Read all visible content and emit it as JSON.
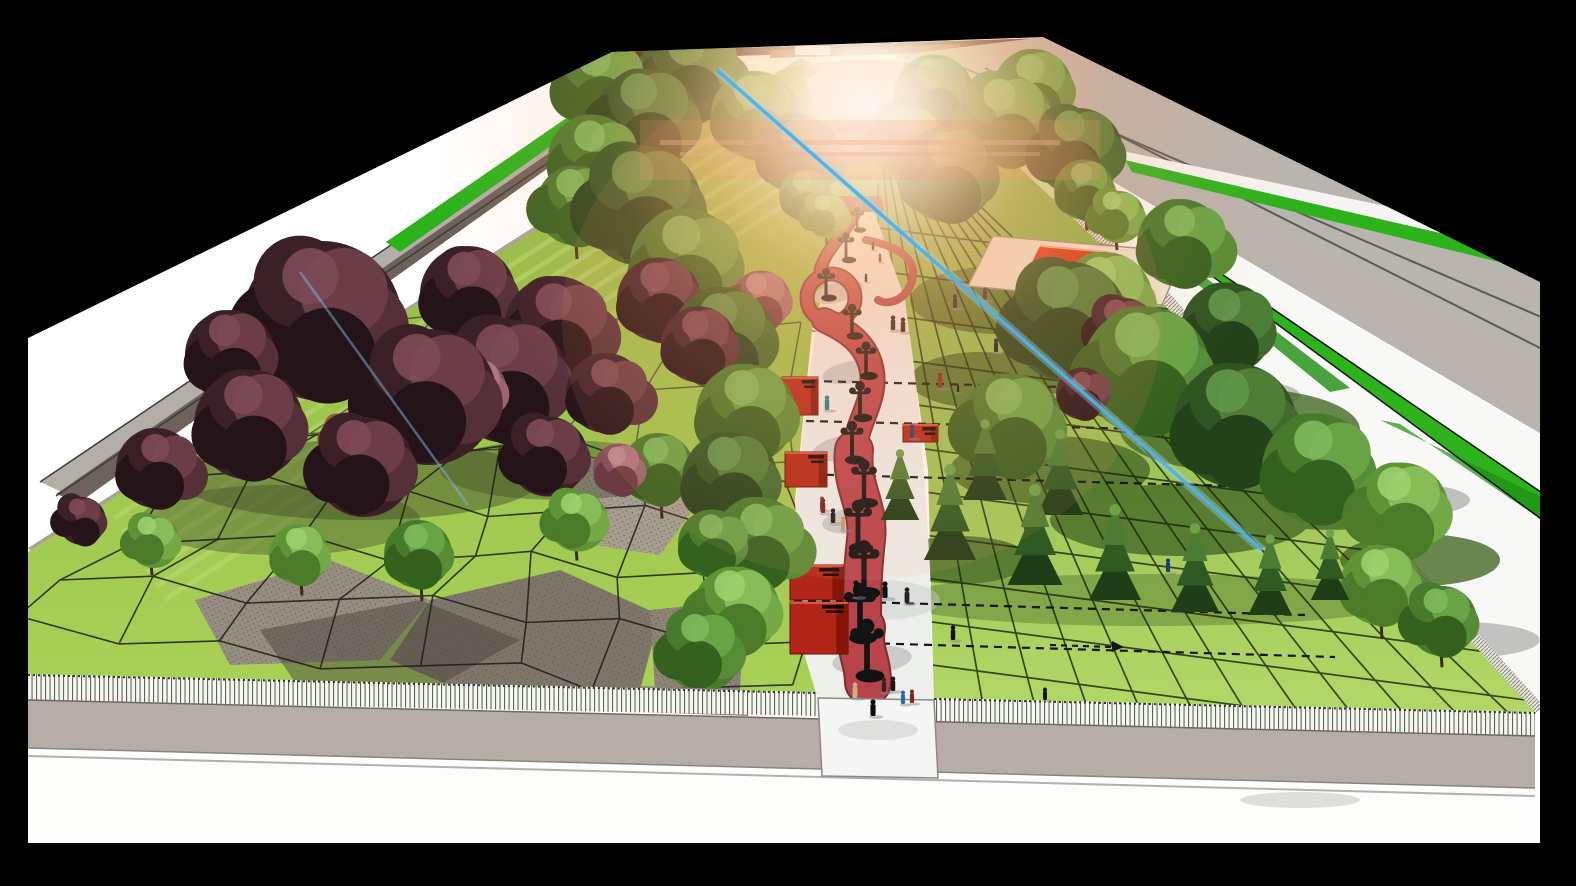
{
  "scene": {
    "title": "park-masterplan-perspective-rendering",
    "description": "Aerial one-point-perspective SketchUp-style rendering of a linear park between two roads: central promenade with red serpentine path, ornate lamppost silhouettes, red wayfinding signs, purple and green tree groves, gridded lawns with gravel patches, white picket fence, flat pavilion with red skylight, sun flare and blue lens streaks, black letterbox frame.",
    "colors": {
      "frame_black": "#000000",
      "sky_white": "#ffffff",
      "horizon_maroon": "#4f1d20",
      "field_green": "#7fbc33",
      "hedge_green": "#2cb31c",
      "hedge_green_dark": "#1d8f12",
      "road_gray": "#b9b4ae",
      "median_light": "#b3aea6",
      "median_dark": "#6d6159",
      "curb_gray": "#a9a299",
      "fence_band": "#e6e3dc",
      "lawn_left": "#9cc24d",
      "lawn_left_deep": "#8ab542",
      "lawn_right_light": "#b2d765",
      "lawn_right_dark": "#7aa83e",
      "lawn_shadow": "#476a26",
      "gravel": "#968e80",
      "gravel_dark": "#7e7769",
      "gravel_light": "#a79e8f",
      "grid_line": "#1c1c1c",
      "promenade": "#edefed",
      "pavement_shadow": "#c6c9c6",
      "ribbon_red": "#b8434b",
      "ribbon_edge": "#7e2b31",
      "deck_red": "#7c2c2d",
      "sign_red": "#b22618",
      "sign_shade": "#841608",
      "pavilion_roof": "#ece5d2",
      "pavilion_skylight": "#d63c16",
      "pavilion_skylight_front": "#8c1d0a",
      "picket_white": "#f5f7f1",
      "sidewalk": "#b6aea6",
      "street_white": "#fdfdfc",
      "flare_warm": "#ffb77e",
      "streak_blue": "#4fb3e6",
      "hill_left": "#8ba04e",
      "hill_right": "#97a45c",
      "silhouette": "#141414"
    },
    "sun_flare": {
      "cx": 862,
      "cy": 108,
      "radius": 430
    },
    "lens_streaks": [
      {
        "x1": 717,
        "y1": 70,
        "x2": 1262,
        "y2": 550
      },
      {
        "x1": 300,
        "y1": 272,
        "x2": 468,
        "y2": 505
      }
    ],
    "trees": [
      [
        600,
        85,
        46,
        "green-mid"
      ],
      [
        692,
        75,
        50,
        "green-dark"
      ],
      [
        935,
        95,
        40,
        "green-dark"
      ],
      [
        1035,
        90,
        40,
        "green-mid"
      ],
      [
        645,
        120,
        52,
        "green-dark"
      ],
      [
        755,
        115,
        44,
        "green-mid"
      ],
      [
        905,
        140,
        36,
        "green-mid"
      ],
      [
        1005,
        120,
        46,
        "green-mid"
      ],
      [
        800,
        155,
        40,
        "green-dark"
      ],
      [
        595,
        160,
        44,
        "green-mid"
      ],
      [
        1075,
        150,
        44,
        "green-dark"
      ],
      [
        950,
        175,
        48,
        "green-dark"
      ],
      [
        805,
        195,
        26,
        "green-mid"
      ],
      [
        1085,
        190,
        30,
        "green-mid"
      ],
      [
        575,
        205,
        40,
        "green-mid"
      ],
      [
        640,
        205,
        60,
        "green-dark"
      ],
      [
        825,
        215,
        22,
        "green-light"
      ],
      [
        1115,
        215,
        26,
        "green-light"
      ],
      [
        1185,
        245,
        44,
        "green-mid"
      ],
      [
        688,
        265,
        55,
        "green-mid"
      ],
      [
        660,
        300,
        42,
        "purple"
      ],
      [
        470,
        295,
        48,
        "purple"
      ],
      [
        1105,
        300,
        48,
        "green-light"
      ],
      [
        760,
        300,
        30,
        "mauve"
      ],
      [
        320,
        320,
        80,
        "purple"
      ],
      [
        1065,
        320,
        60,
        "green-dark"
      ],
      [
        1120,
        330,
        34,
        "purple"
      ],
      [
        230,
        355,
        45,
        "purple"
      ],
      [
        560,
        330,
        52,
        "purple"
      ],
      [
        725,
        340,
        52,
        "green-dark"
      ],
      [
        505,
        380,
        62,
        "purple"
      ],
      [
        1145,
        370,
        64,
        "green-mid"
      ],
      [
        1230,
        330,
        46,
        "green-dark"
      ],
      [
        425,
        395,
        68,
        "purple"
      ],
      [
        610,
        395,
        40,
        "purple"
      ],
      [
        700,
        345,
        38,
        "purple"
      ],
      [
        1085,
        395,
        26,
        "purple"
      ],
      [
        748,
        415,
        50,
        "green-mid"
      ],
      [
        250,
        425,
        55,
        "purple"
      ],
      [
        1235,
        425,
        62,
        "green-dark"
      ],
      [
        470,
        390,
        34,
        "mauve"
      ],
      [
        345,
        438,
        22,
        "orange"
      ],
      [
        360,
        465,
        50,
        "purple"
      ],
      [
        160,
        470,
        40,
        "purple"
      ],
      [
        1320,
        470,
        55,
        "green-mid"
      ],
      [
        545,
        455,
        40,
        "purple"
      ],
      [
        730,
        480,
        48,
        "green-dark"
      ],
      [
        660,
        470,
        36,
        "green-mid"
      ],
      [
        1400,
        510,
        48,
        "green-light"
      ],
      [
        1010,
        425,
        52,
        "green-mid"
      ],
      [
        80,
        520,
        24,
        "purple"
      ],
      [
        575,
        520,
        30,
        "green-light"
      ],
      [
        620,
        470,
        26,
        "mauve"
      ],
      [
        762,
        545,
        46,
        "green-mid"
      ],
      [
        715,
        545,
        34,
        "green-mid"
      ],
      [
        420,
        555,
        34,
        "green-mid"
      ],
      [
        300,
        555,
        30,
        "green-light"
      ],
      [
        150,
        540,
        26,
        "green-light"
      ],
      [
        1380,
        585,
        40,
        "green-light"
      ],
      [
        1440,
        620,
        35,
        "green-mid"
      ],
      [
        735,
        610,
        44,
        "green-light"
      ],
      [
        700,
        650,
        40,
        "green-mid"
      ]
    ],
    "conifers": [
      [
        900,
        520,
        70
      ],
      [
        985,
        500,
        80
      ],
      [
        1060,
        515,
        85
      ],
      [
        950,
        560,
        95
      ],
      [
        1035,
        585,
        100
      ],
      [
        1115,
        600,
        95
      ],
      [
        1195,
        612,
        88
      ],
      [
        1270,
        615,
        80
      ],
      [
        1330,
        600,
        70
      ]
    ],
    "lampposts": [
      [
        857,
        232,
        22
      ],
      [
        846,
        262,
        26
      ],
      [
        826,
        300,
        28
      ],
      [
        852,
        338,
        30
      ],
      [
        866,
        378,
        32
      ],
      [
        860,
        420,
        34
      ],
      [
        852,
        462,
        36
      ],
      [
        864,
        505,
        40
      ],
      [
        858,
        550,
        44
      ],
      [
        864,
        595,
        48
      ],
      [
        860,
        640,
        50
      ],
      [
        867,
        678,
        52
      ]
    ],
    "signs": [
      {
        "x": 782,
        "y": 377,
        "w": 36,
        "h": 38
      },
      {
        "x": 785,
        "y": 452,
        "w": 42,
        "h": 35
      },
      {
        "x": 790,
        "y": 565,
        "w": 53,
        "h": 35
      },
      {
        "x": 790,
        "y": 602,
        "w": 58,
        "h": 52
      },
      {
        "x": 903,
        "y": 424,
        "w": 35,
        "h": 18
      }
    ],
    "dashed_lines": [
      [
        810,
        381,
        1150,
        389
      ],
      [
        806,
        421,
        1185,
        430
      ],
      [
        798,
        474,
        1235,
        486
      ],
      [
        794,
        600,
        1305,
        615
      ],
      [
        798,
        641,
        1335,
        657
      ]
    ],
    "people": [
      [
        873,
        250,
        8,
        "#111111"
      ],
      [
        880,
        262,
        8,
        "#222222"
      ],
      [
        866,
        282,
        8,
        "#111111"
      ],
      [
        893,
        330,
        14,
        "#1a1a1a"
      ],
      [
        903,
        332,
        14,
        "#1a1a1a"
      ],
      [
        955,
        308,
        13,
        "#222222"
      ],
      [
        985,
        300,
        12,
        "#333333"
      ],
      [
        940,
        388,
        15,
        "#8a2a20"
      ],
      [
        958,
        392,
        7,
        "#111111"
      ],
      [
        996,
        352,
        13,
        "#1a1a1a"
      ],
      [
        912,
        438,
        13,
        "#203a6e"
      ],
      [
        827,
        410,
        14,
        "#1f7a8a"
      ],
      [
        822,
        510,
        13,
        "#555555"
      ],
      [
        856,
        597,
        16,
        "#111111"
      ],
      [
        907,
        603,
        15,
        "#222222"
      ],
      [
        823,
        513,
        14,
        "#7a1f1f"
      ],
      [
        833,
        523,
        14,
        "#1a1a1a"
      ],
      [
        843,
        530,
        13,
        "#c49a6a"
      ],
      [
        885,
        598,
        16,
        "#111111"
      ],
      [
        1168,
        572,
        13,
        "#203a7a"
      ],
      [
        953,
        640,
        14,
        "#111111"
      ],
      [
        855,
        698,
        15,
        "#c8b088"
      ],
      [
        873,
        716,
        16,
        "#0d0d0d"
      ],
      [
        884,
        692,
        14,
        "#3a2418"
      ],
      [
        893,
        691,
        14,
        "#1f140e"
      ],
      [
        903,
        704,
        13,
        "#2a6ab0"
      ],
      [
        912,
        703,
        13,
        "#7a2a1f"
      ],
      [
        1045,
        700,
        12,
        "#111111"
      ]
    ],
    "counts": {
      "trees": 62,
      "conifers": 9,
      "lampposts": 12,
      "signs": 5,
      "people": 27
    }
  }
}
